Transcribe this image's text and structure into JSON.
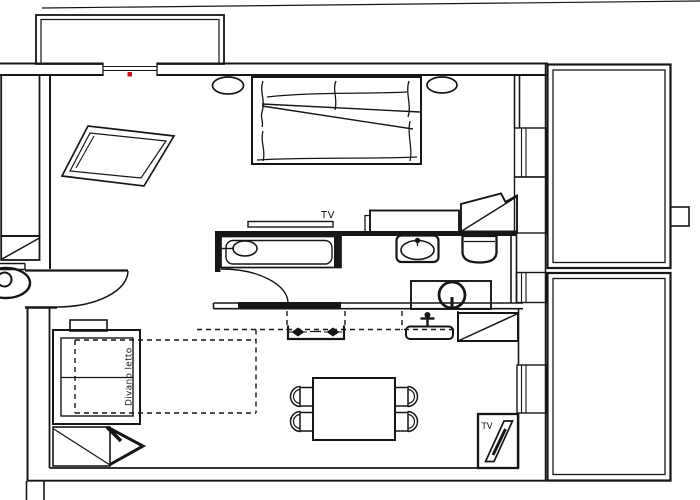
{
  "title": "Apartment floor plan sketch",
  "colors": {
    "ink": "#161616",
    "paper": "#ffffff",
    "window_marker": "#c3161c"
  },
  "labels": {
    "bedroom_tv": "TV",
    "living_tv": "TV",
    "sofa_bed": "Divano letto"
  },
  "elements": [
    "balcony",
    "balcony-window",
    "window-marker",
    "stair-column",
    "hatched-box",
    "entrance-door",
    "unit-symbol",
    "double-bed",
    "bedside-lamp-left",
    "bedside-lamp-right",
    "rotated-side-table",
    "tv-shelf",
    "dresser",
    "corner-wardrobe",
    "bathtub",
    "bathroom-door",
    "washbasin",
    "toilet",
    "shower",
    "kitchen-counter",
    "cooktop",
    "kitchen-sink",
    "kitchen-faucet",
    "appliance-box",
    "sofa-bed",
    "sofa-bed-extension",
    "side-table",
    "folding-lounge-chair",
    "dining-table",
    "dining-chair",
    "tv-cabinet",
    "loggia-upper",
    "loggia-lower",
    "loggia-divider",
    "wall-window"
  ]
}
